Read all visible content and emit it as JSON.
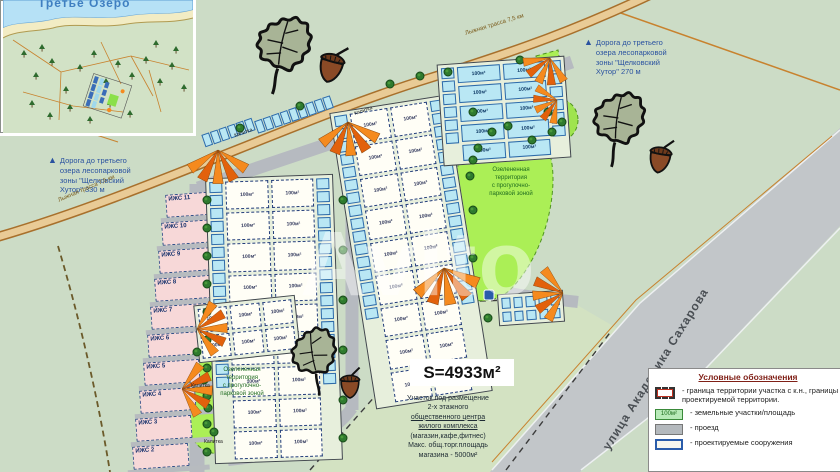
{
  "watermark": "Avito",
  "inset": {
    "lake_label": "Третье Озеро"
  },
  "annotations": {
    "road_left_lines": [
      "Дорога до третьего",
      "озера лесопарковой",
      "зоны \"Щелковский",
      "Хутор\" 330 м"
    ],
    "road_top_lines": [
      "Дорога до третьего",
      "озера лесопарковой",
      "зоны \"Щелковский",
      "Хутор\" 270 м"
    ],
    "ski_track": "Лыжная трасса 7,5 км",
    "street": "улица Академика Сахарова",
    "green_zone_lines": [
      "Озелененная",
      "территория",
      "с прогулочно-",
      "парковой зоной"
    ],
    "gate": "Калитка",
    "area_value": "S=4933м²",
    "public_center_lines": [
      "Участок под размещение",
      "2-х этажного",
      "общественного центра",
      "жилого комплекса",
      "(магазин,кафе,фитнес)",
      "Макс. общ.торг.площадь",
      "магазина - 5000м²"
    ],
    "public_center_underline": [
      2,
      3
    ]
  },
  "plots_left": [
    "ИЖС 11",
    "ИЖС 10",
    "ИЖС 9",
    "ИЖС 8",
    "ИЖС 7",
    "ИЖС 6",
    "ИЖС 5",
    "ИЖС 4",
    "ИЖС 3",
    "ИЖС 2"
  ],
  "cell_label": "100м²",
  "legend": {
    "title": "Условные обозначения",
    "items": [
      {
        "swatch": "boundary",
        "label": "- граница территории участка с к.н., границы проектируемой территории."
      },
      {
        "swatch": "plot",
        "swatch_label": "100м²",
        "label": "- земельные участки/площадь"
      },
      {
        "swatch": "road",
        "label": "- проезд"
      },
      {
        "swatch": "build",
        "label": "- проектируемые сооружения"
      }
    ]
  },
  "colors": {
    "background_green": "#ccdcc6",
    "road_gray": "#c2c6c9",
    "boundary_tan": "#c8822e",
    "plot_pink": "#f7d8d8",
    "parking_cyan": "#b9e7f4",
    "green_zone": "#abef56",
    "entrance_orange": "#f58a1e",
    "annotation_blue": "#2a52a0",
    "legend_title_red": "#7f1f16"
  }
}
